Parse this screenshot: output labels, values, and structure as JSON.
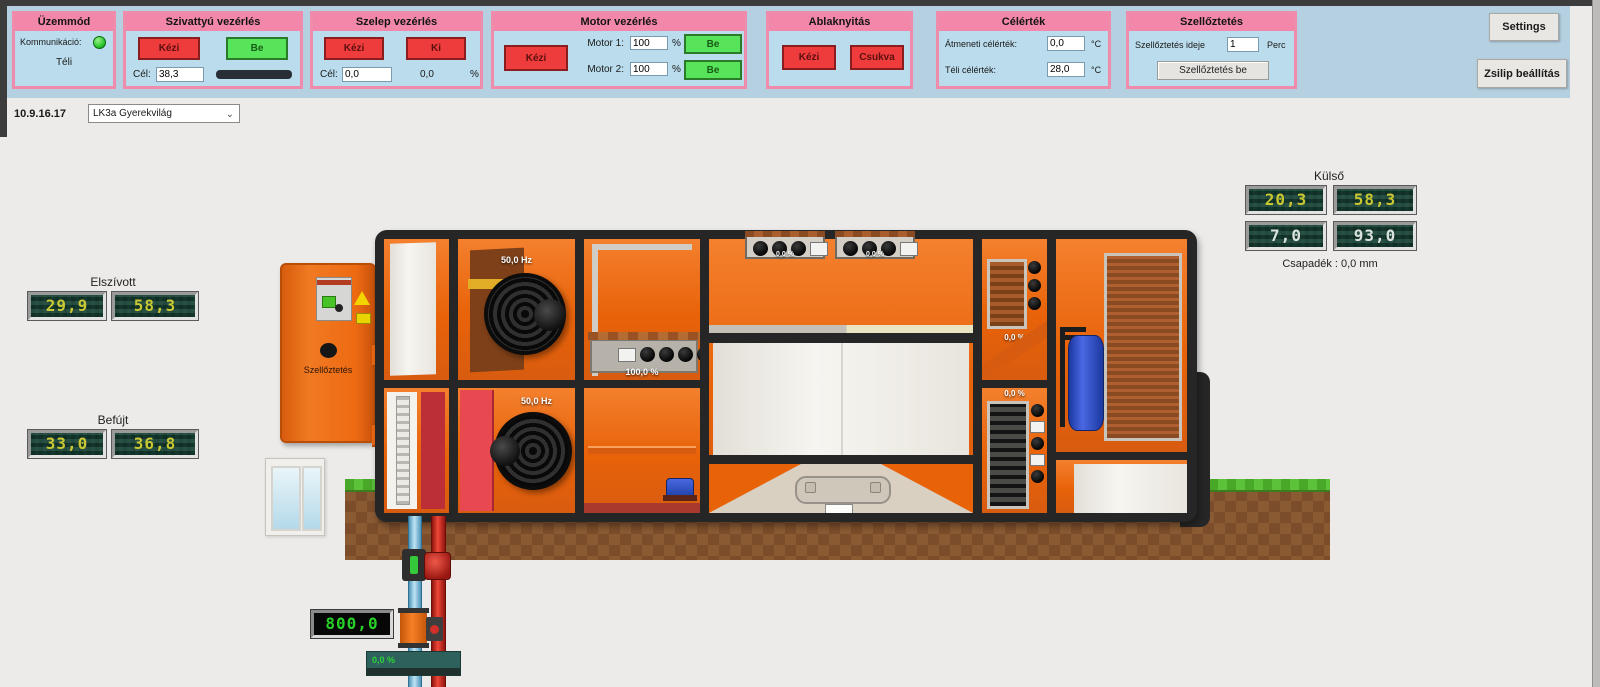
{
  "colors": {
    "accent_pink": "#f287a9",
    "panel_blue": "#badcec",
    "button_red": "#ee3b3b",
    "button_green": "#58e45a",
    "orange": "#ee6a12",
    "seg_yellow": "#c9c832",
    "flow_green": "#28d028"
  },
  "toolbar": {
    "uzemmod": {
      "title": "Üzemmód",
      "komm_label": "Kommunikáció:",
      "mode": "Téli"
    },
    "szivattyu": {
      "title": "Szivattyú vezérlés",
      "kezi": "Kézi",
      "be": "Be",
      "cel_label": "Cél:",
      "cel_value": "38,3"
    },
    "szelep": {
      "title": "Szelep vezérlés",
      "kezi": "Kézi",
      "ki": "Ki",
      "cel_label": "Cél:",
      "cel_value": "0,0",
      "pos_value": "0,0",
      "unit": "%"
    },
    "motor": {
      "title": "Motor vezérlés",
      "kezi": "Kézi",
      "m1_label": "Motor 1:",
      "m1_value": "100",
      "m2_label": "Motor 2:",
      "m2_value": "100",
      "unit": "%",
      "be1": "Be",
      "be2": "Be"
    },
    "ablak": {
      "title": "Ablaknyitás",
      "kezi": "Kézi",
      "csukva": "Csukva"
    },
    "celertek": {
      "title": "Célérték",
      "atmeneti_label": "Átmeneti célérték:",
      "atmeneti_value": "0,0",
      "teli_label": "Téli célérték:",
      "teli_value": "28,0",
      "unit1": "°C",
      "unit2": "°C"
    },
    "szelloztetes": {
      "title": "Szellőztetés",
      "ideje_label": "Szellőztetés ideje",
      "ideje_value": "1",
      "perc": "Perc",
      "be_button": "Szellőztetés be"
    },
    "settings": "Settings",
    "zsilip": "Zsilip beállítás"
  },
  "selector": {
    "ip": "10.9.16.17",
    "device": "LK3a Gyerekvilág"
  },
  "displays": {
    "elszivott": {
      "label": "Elszívott",
      "values": [
        "29,9",
        "58,3"
      ]
    },
    "befujt": {
      "label": "Befújt",
      "values": [
        "33,0",
        "36,8"
      ]
    },
    "kulso": {
      "label": "Külső",
      "row1": [
        "20,3",
        "58,3"
      ],
      "row2": [
        "7,0",
        "93,0"
      ],
      "csapadek": "Csapadék : 0,0 mm"
    },
    "flow": "800,0",
    "valve_bar": "0,0 %"
  },
  "unit": {
    "cabinet_label": "Szellőztetés",
    "fan_top": "50,0 Hz",
    "fan_bottom": "50,0 Hz",
    "recuperator": "100,0 %",
    "damper_top_left": "0,0 %",
    "damper_top_right": "0,0 %",
    "damper_right_top": "0,0 %",
    "damper_right_bottom": "0,0 %"
  }
}
